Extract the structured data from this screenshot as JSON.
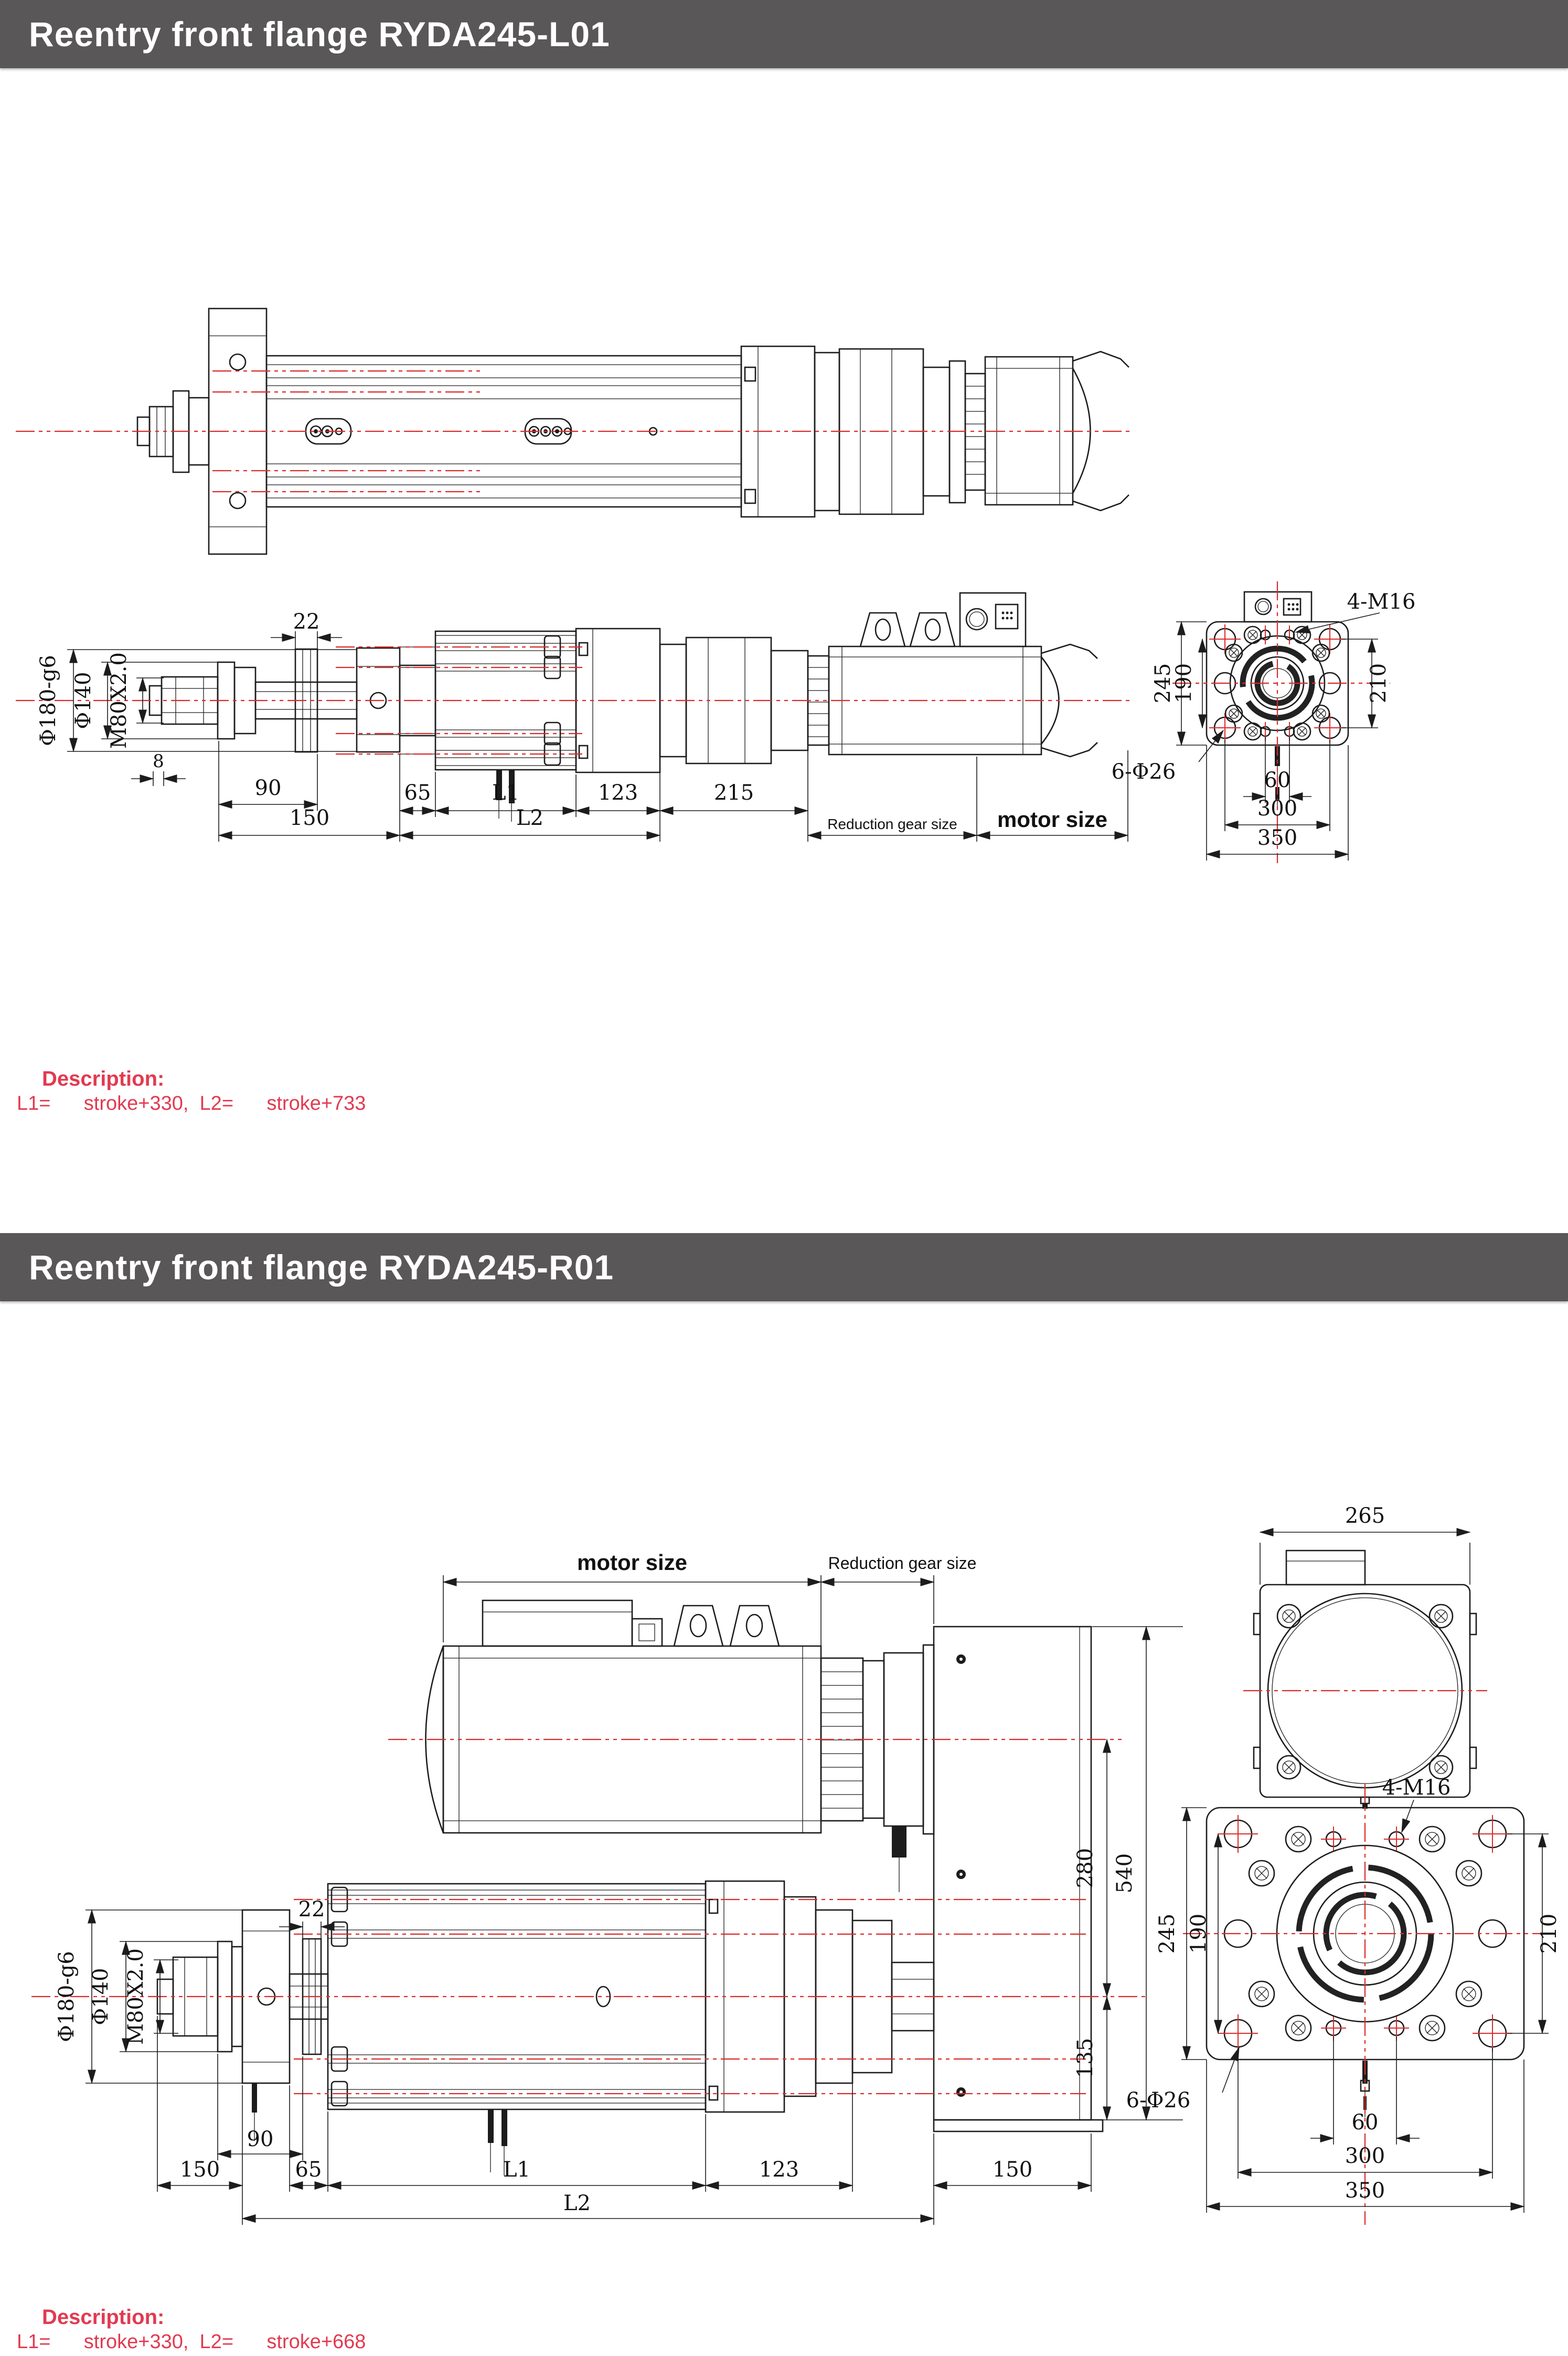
{
  "colors": {
    "header_bg": "#595757",
    "header_text": "#ffffff",
    "accent_red": "#e23a50",
    "line": "#1c1c1c",
    "centerline_red": "#d92b2b"
  },
  "header1": {
    "title": "Reentry front flange RYDA245-L01"
  },
  "header2": {
    "title": "Reentry front flange RYDA245-R01"
  },
  "desc1": {
    "label": "Description:",
    "line": "L1=      stroke+330,  L2=      stroke+733"
  },
  "desc2": {
    "label": "Description:",
    "line": "L1=      stroke+330,  L2=      stroke+668"
  },
  "d1": {
    "side": {
      "d22": "22",
      "phi180": "Φ180-g6",
      "phi140": "Φ140",
      "m80": "M80X2.0",
      "d8": "8",
      "d90": "90",
      "d150": "150",
      "d65": "65",
      "l1": "L1",
      "d123": "123",
      "d215": "215",
      "l2": "L2",
      "reduction_label": "Reduction gear size",
      "motor_label": "motor size"
    },
    "flange": {
      "m16": "4-M16",
      "phi26": "6-Φ26",
      "d245": "245",
      "d190": "190",
      "d210": "210",
      "d60": "60",
      "d300": "300",
      "d350": "350"
    }
  },
  "d2": {
    "side": {
      "motor_label": "motor size",
      "reduction_label": "Reduction gear size",
      "d22": "22",
      "phi180": "Φ180-g6",
      "phi140": "Φ140",
      "m80": "M80X2.0",
      "d280": "280",
      "d540": "540",
      "d135": "135",
      "d90": "90",
      "d150_left": "150",
      "d65": "65",
      "l1": "L1",
      "d123": "123",
      "d150_right": "150",
      "l2": "L2"
    },
    "rear": {
      "d265": "265"
    },
    "flange": {
      "m16": "4-M16",
      "phi26": "6-Φ26",
      "d245": "245",
      "d190": "190",
      "d210": "210",
      "d60": "60",
      "d300": "300",
      "d350": "350"
    }
  }
}
